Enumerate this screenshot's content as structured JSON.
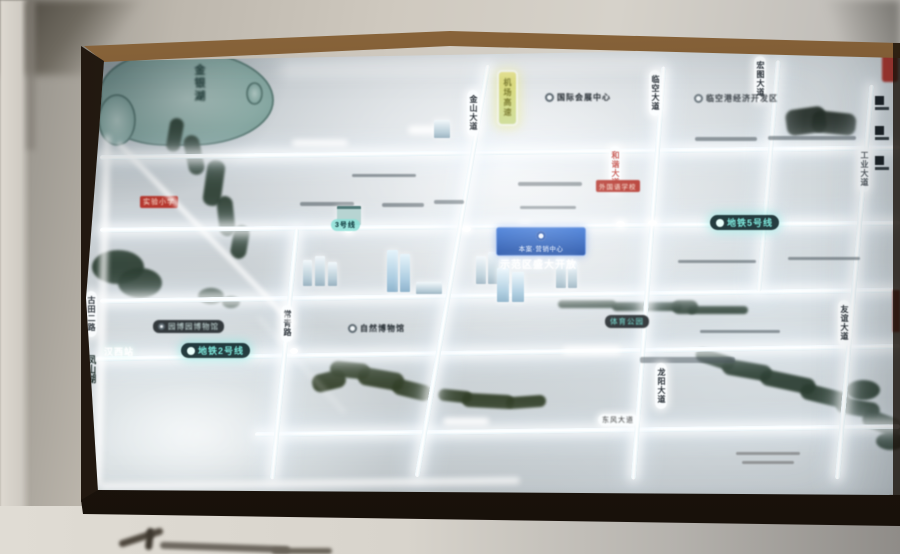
{
  "map": {
    "water": {
      "lake_topleft": "金银湖",
      "lake_left": "凤山湖"
    },
    "roads": {
      "pill_1": "金山大道",
      "pill_2": "临空大道",
      "pill_3": "宏图大道",
      "pill_red": "和谐大道",
      "pill_4": "古田二路",
      "pill_5": "常青路",
      "pill_6": "龙阳大道",
      "pill_7": "友谊大道",
      "pill_8": "工业大道",
      "yellow_badge": "机场高速",
      "bottom_pill": "东风大道"
    },
    "metro": {
      "line2": "地铁2号线",
      "line5": "地铁5号线",
      "line3": "3号线",
      "station_hanxi": "汉西站"
    },
    "pois": {
      "expo": "国际会展中心",
      "airport_zone": "临空港经济开发区",
      "museum_pill": "园博园博物馆",
      "museum_text": "自然博物馆",
      "park": "体育公园"
    },
    "badges": {
      "school_left": "实验小学",
      "school_right": "外国语学校"
    },
    "project": {
      "sign": "本案·营销中心",
      "glow": "示范区盛大开放"
    }
  },
  "colors": {
    "metro_teal": "#7de8dc",
    "project_blue": "#1b55b4",
    "badge_red": "#b5372e",
    "road_glow": "#ffffff",
    "water_green": "#2c3e32",
    "highlight_yellow": "#ddd97e",
    "frame_brown": "#3a2715"
  }
}
